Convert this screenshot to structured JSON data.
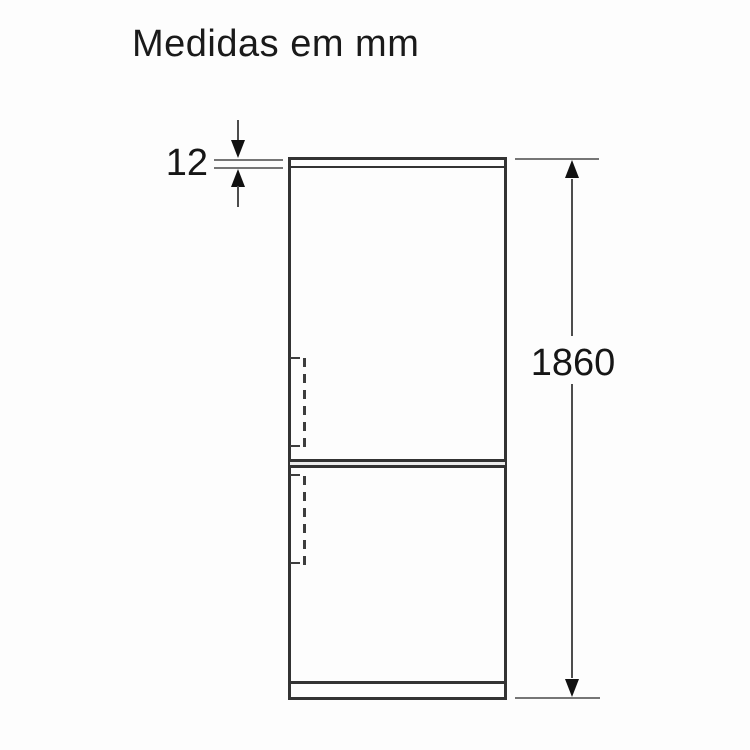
{
  "title": "Medidas em mm",
  "diagram": {
    "type": "product-dimension-diagram",
    "unit": "mm",
    "dimensions": {
      "top_panel": {
        "label": "12"
      },
      "height": {
        "label": "1860"
      }
    },
    "colors": {
      "background": "#fdfdfd",
      "outline": "#333333",
      "extension_line": "#767676",
      "dimension_line": "#4d4d4d",
      "arrow": "#111111",
      "text": "#161616"
    }
  }
}
